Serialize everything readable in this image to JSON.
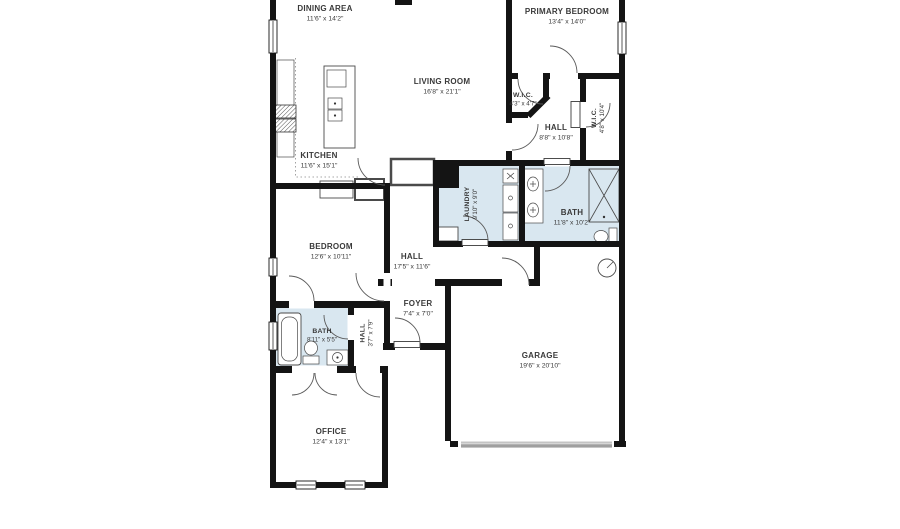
{
  "theme": {
    "wall": "#141414",
    "wet": "#d9e7f0",
    "label": "#3a3a3a",
    "bg": "#ffffff",
    "door-bar": "#9f9f9f"
  },
  "plan": {
    "type": "residential-floor-plan",
    "rooms": [
      {
        "name": "DINING AREA",
        "dims": "11'6\" x 14'2\""
      },
      {
        "name": "PRIMARY BEDROOM",
        "dims": "13'4\" x 14'0\""
      },
      {
        "name": "LIVING ROOM",
        "dims": "16'8\" x 21'1\""
      },
      {
        "name": "W.I.C.",
        "dims": "4'3\" x 4'7\""
      },
      {
        "name": "HALL",
        "dims": "8'8\" x 10'8\""
      },
      {
        "name": "W.I.C.",
        "dims": "4'8\" x 10'4\""
      },
      {
        "name": "KITCHEN",
        "dims": "11'6\" x 15'1\""
      },
      {
        "name": "LAUNDRY",
        "dims": "9'10\" x 9'0\""
      },
      {
        "name": "BATH",
        "dims": "11'8\" x 10'2\""
      },
      {
        "name": "BEDROOM",
        "dims": "12'6\" x 10'11\""
      },
      {
        "name": "HALL",
        "dims": "17'5\" x 11'6\""
      },
      {
        "name": "FOYER",
        "dims": "7'4\" x 7'0\""
      },
      {
        "name": "BATH",
        "dims": "8'11\" x 5'5\""
      },
      {
        "name": "HALL",
        "dims": "3'7\" x 7'9\""
      },
      {
        "name": "GARAGE",
        "dims": "19'6\" x 20'10\""
      },
      {
        "name": "OFFICE",
        "dims": "12'4\" x 13'1\""
      }
    ]
  }
}
